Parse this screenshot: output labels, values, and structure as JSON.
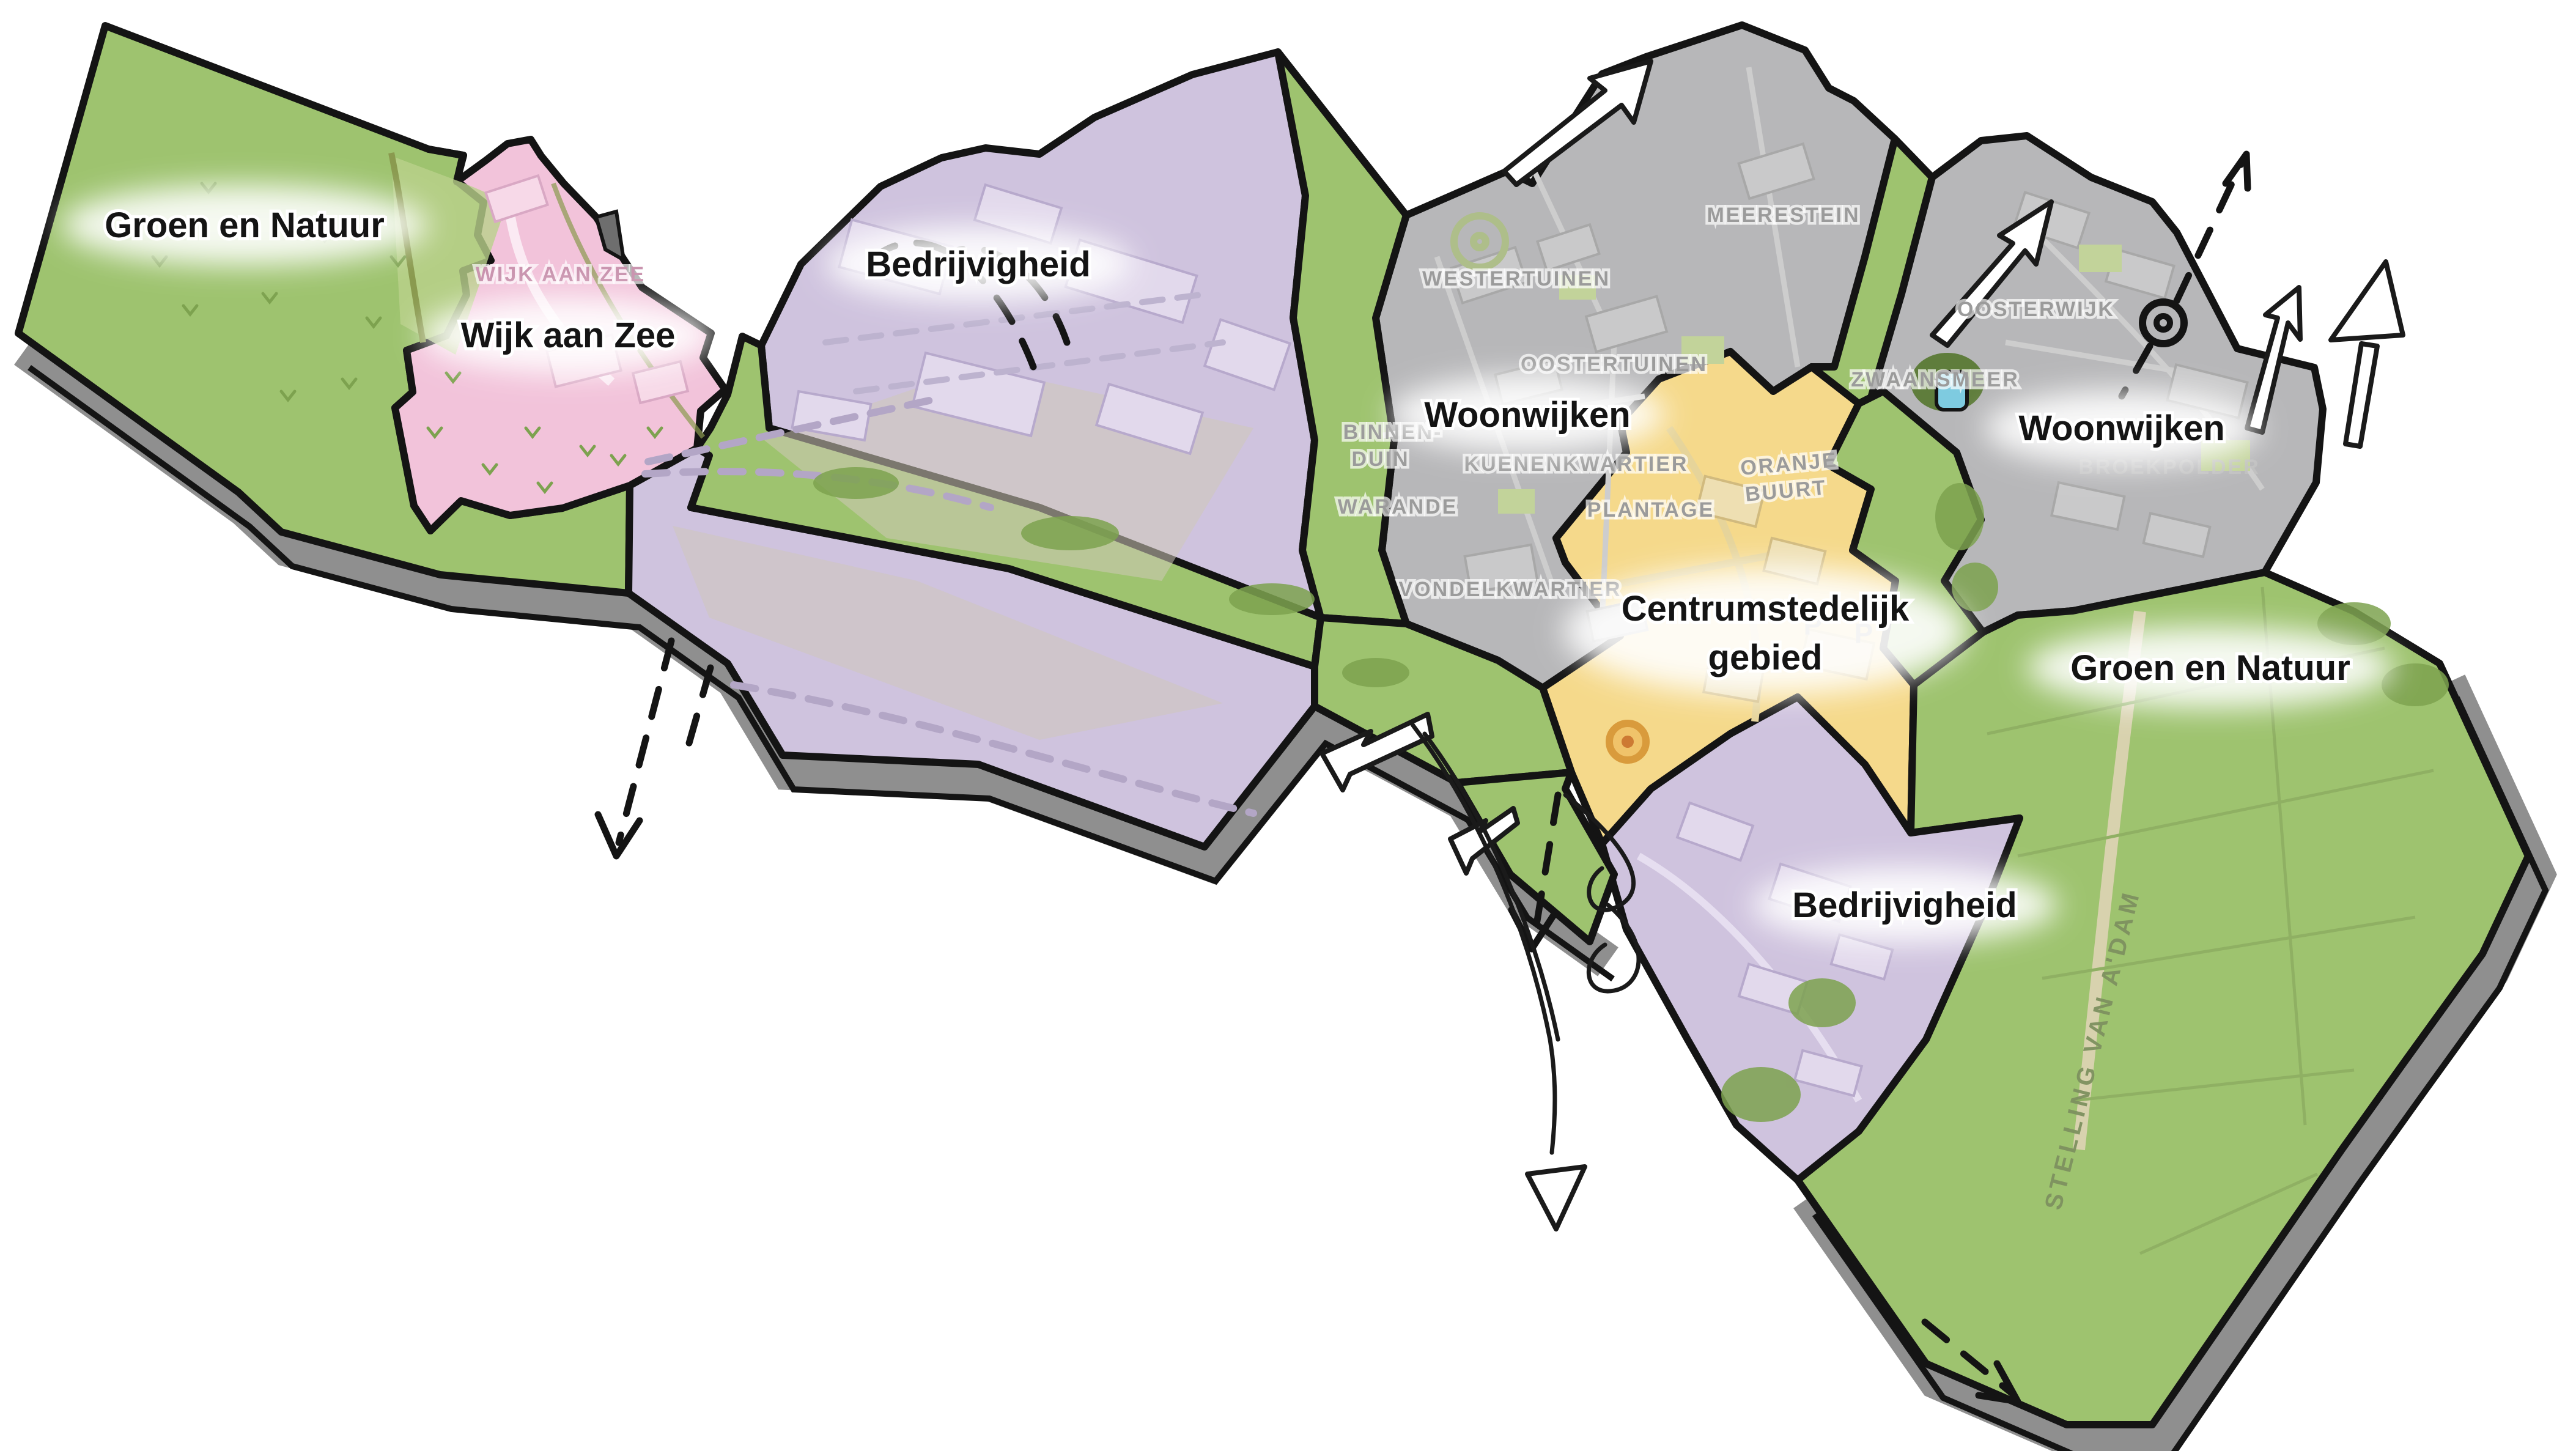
{
  "map_title": "Gebiedskaart",
  "colors": {
    "green_main": "#9ec36f",
    "green_light": "#b9d18b",
    "green_dark": "#7da24f",
    "pink": "#f2c3da",
    "pink_light": "#f7d9e8",
    "purple": "#cfc3de",
    "purple_light": "#e2d9ec",
    "gray_zone": "#b7b7b9",
    "gray_light": "#c9c9ca",
    "yellow": "#f5d98b",
    "yellow_light": "#eedfb2",
    "water": "#7ecbe0",
    "slab": "#8f8f8f",
    "slab_dark": "#6e6e6e",
    "road_tan": "#cfc8b8",
    "outline": "#141414"
  },
  "zones": [
    {
      "id": "groen-natuur-west",
      "label": "Groen en Natuur"
    },
    {
      "id": "wijk-aan-zee",
      "label": "Wijk aan Zee"
    },
    {
      "id": "bedrijvigheid-noord",
      "label": "Bedrijvigheid"
    },
    {
      "id": "woonwijken-west",
      "label": "Woonwijken"
    },
    {
      "id": "centrumstedelijk-gebied",
      "label_line1": "Centrumstedelijk",
      "label_line2": "gebied"
    },
    {
      "id": "woonwijken-oost",
      "label": "Woonwijken"
    },
    {
      "id": "groen-natuur-oost",
      "label": "Groen en Natuur"
    },
    {
      "id": "bedrijvigheid-zuid",
      "label": "Bedrijvigheid"
    }
  ],
  "neighborhoods": [
    "WIJK AAN ZEE",
    "WESTERTUINEN",
    "OOSTERTUINEN",
    "KUENENKWARTIER",
    "BINNEN-",
    "DUIN",
    "WARANDE",
    "PLANTAGE",
    "VONDELKWARTIER",
    "MEERESTEIN",
    "OOSTERWIJK",
    "ZWAANSMEER",
    "ORANJE",
    "BUURT",
    "BROEKPOLDER"
  ],
  "road_label": "STELLING VAN A'DAM",
  "parking_label": "P"
}
